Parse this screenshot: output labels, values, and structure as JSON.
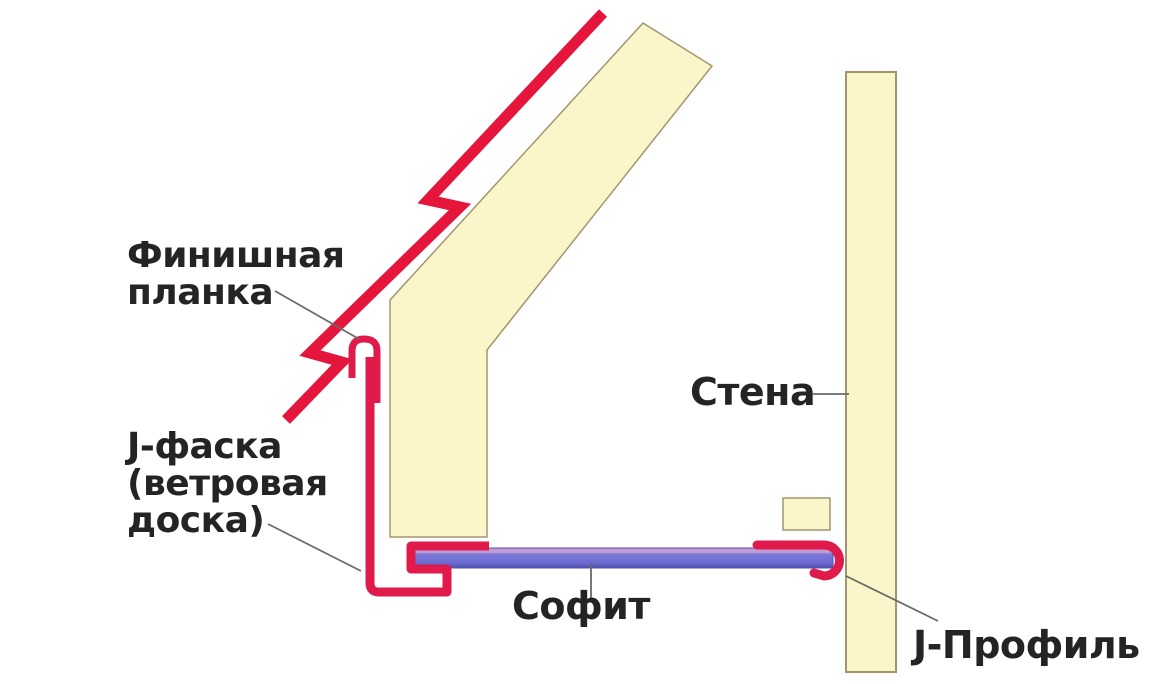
{
  "diagram": {
    "kind": "soffit-installation-scheme",
    "language": "ru"
  },
  "labels": {
    "finish_strip": {
      "line1": "Финишная",
      "line2": "планка"
    },
    "j_fascia": {
      "line1": "J-фаска",
      "line2": "(ветровая",
      "line3": "доска)"
    },
    "soffit": "Софит",
    "wall": "Стена",
    "j_profile": "J-Профиль"
  },
  "colors": {
    "background": "#ffffff",
    "wood_fill": "#faf6c9",
    "wood_outline": "#a5956f",
    "finish_strip_red": "#e6153c",
    "profile_red": "#e01a4a",
    "soffit_body": "#6b6bd1",
    "soffit_top_edge": "#c29cd4",
    "soffit_outline": "#5050ae",
    "label_text": "#242424",
    "leader_line": "#6a6a6a"
  }
}
